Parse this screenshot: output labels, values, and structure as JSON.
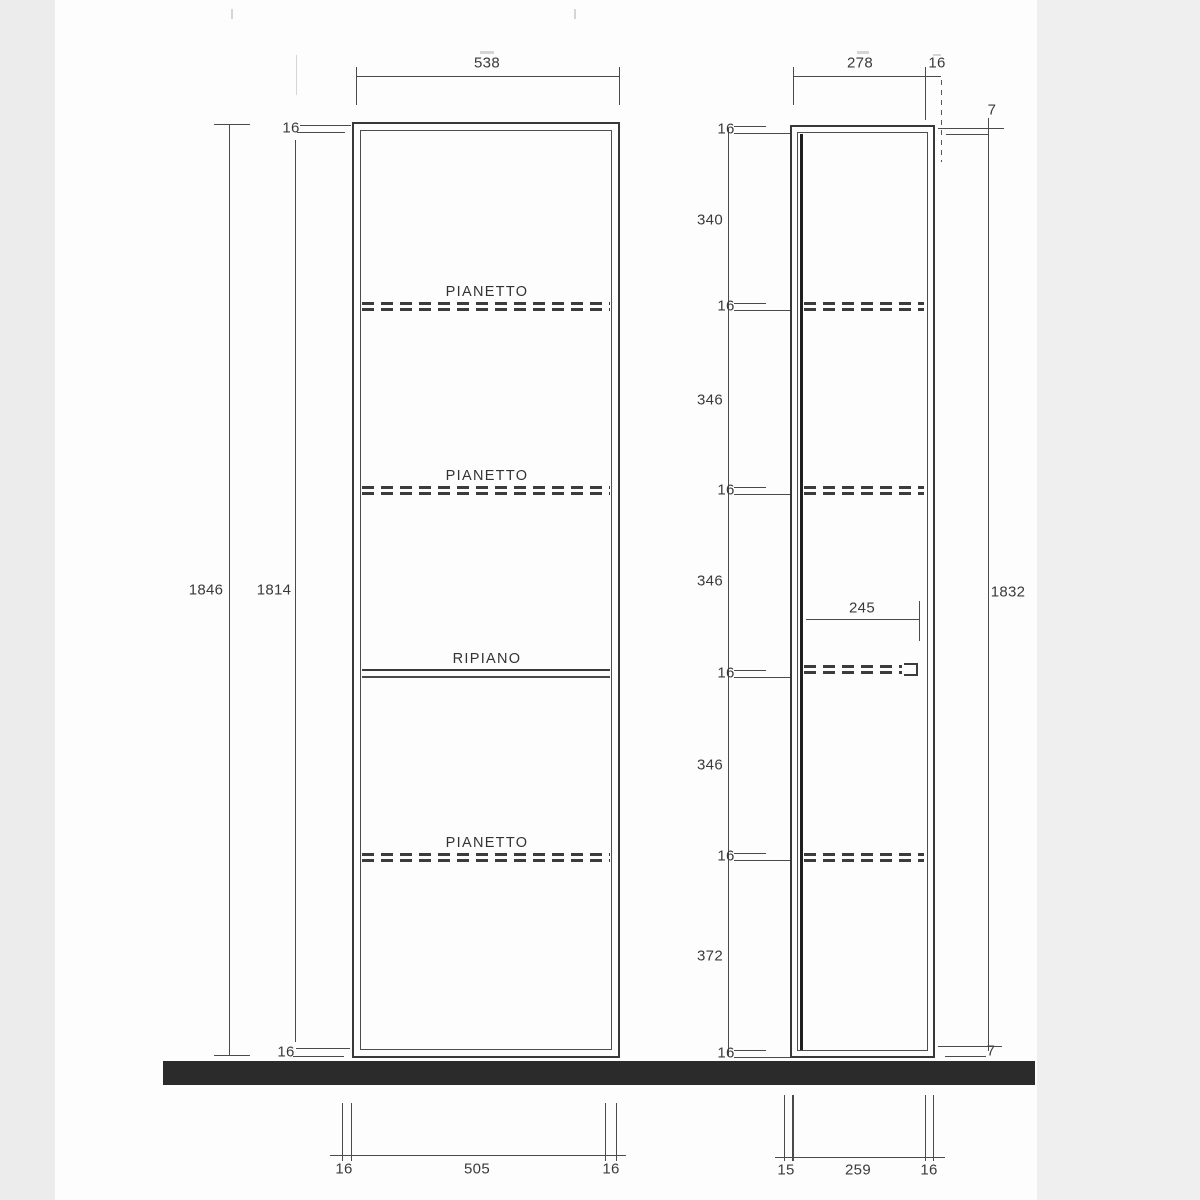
{
  "front_view": {
    "width": "538",
    "outer_height": "1846",
    "inner_height": "1814",
    "top_panel_thickness": "16",
    "bottom_panel_thickness": "16",
    "shelves": [
      {
        "label": "PIANETTO",
        "type": "adjustable-dashed"
      },
      {
        "label": "PIANETTO",
        "type": "adjustable-dashed"
      },
      {
        "label": "RIPIANO",
        "type": "fixed-solid"
      },
      {
        "label": "PIANETTO",
        "type": "adjustable-dashed"
      }
    ],
    "bottom_dims": [
      "16",
      "505",
      "16"
    ]
  },
  "side_view": {
    "depth": "278",
    "back_panel": "16",
    "top_gap": "7",
    "bottom_gap": "7",
    "height": "1832",
    "shelf_depth": "245",
    "bottom_dims": [
      "15",
      "259",
      "16"
    ]
  },
  "vertical_chain": {
    "labels": [
      "16",
      "340",
      "16",
      "346",
      "16",
      "346",
      "16",
      "346",
      "16",
      "372",
      "16"
    ]
  },
  "colors": {
    "line": "#4a4a4a",
    "text": "#3a3a3a",
    "floor_band": "#2b2b2b",
    "scan_margin": "#ececec"
  }
}
